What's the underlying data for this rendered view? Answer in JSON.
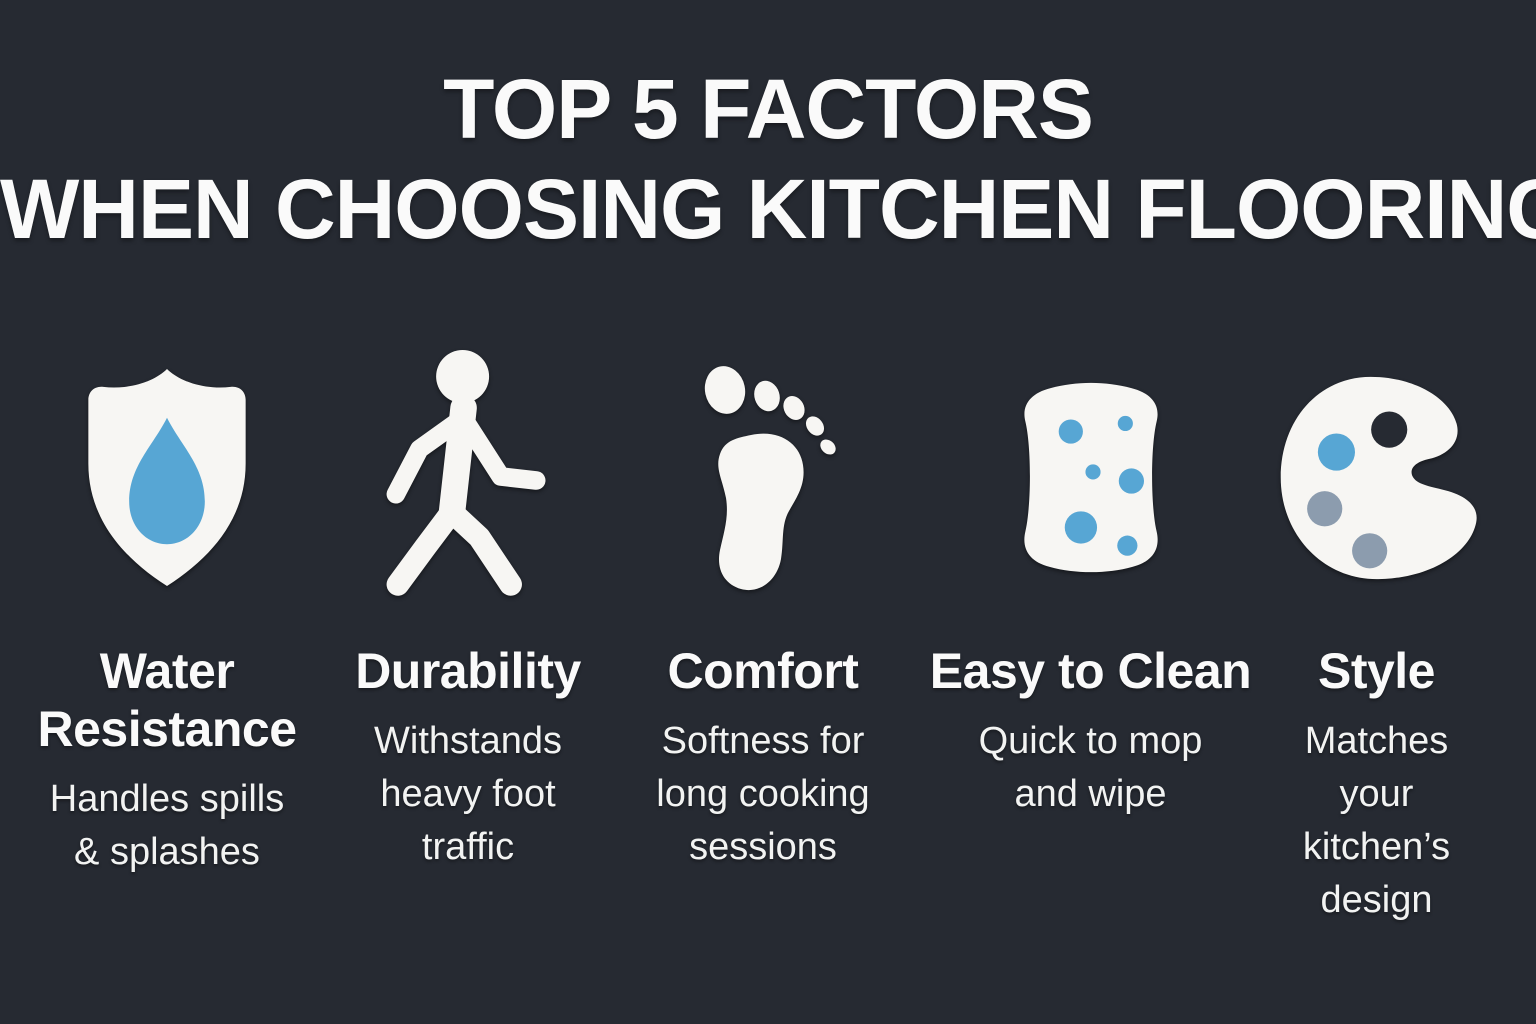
{
  "title": {
    "line1": "TOP 5 FACTORS",
    "line2": "WHEN CHOOSING KITCHEN FLOORING"
  },
  "colors": {
    "background": "#262a32",
    "icon_white": "#f7f6f3",
    "accent_blue": "#57a6d4",
    "muted_blue_gray": "#8c9cae",
    "text": "#fafafa"
  },
  "factors": [
    {
      "icon": "shield-water-drop-icon",
      "title": "Water\nResistance",
      "description": "Handles spills\n& splashes"
    },
    {
      "icon": "walking-person-icon",
      "title": "Durability",
      "description": "Withstands\nheavy foot\ntraffic"
    },
    {
      "icon": "footprint-icon",
      "title": "Comfort",
      "description": "Softness for\nlong cooking\nsessions"
    },
    {
      "icon": "sponge-icon",
      "title": "Easy to Clean",
      "description": "Quick to mop\nand wipe"
    },
    {
      "icon": "palette-icon",
      "title": "Style",
      "description": "Matches\nyour kitchen’s\ndesign"
    }
  ]
}
